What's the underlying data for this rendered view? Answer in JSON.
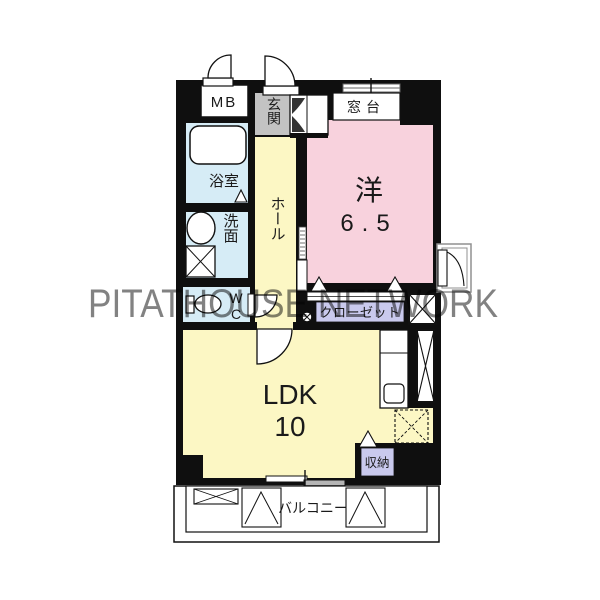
{
  "watermark": {
    "text": "PITATHOUSE NETWORK"
  },
  "colors": {
    "wall": "#0f0f0f",
    "western": "#f8d2dd",
    "ldk": "#fcf7c4",
    "hall": "#fcf7c4",
    "wet": "#d6ecf6",
    "closet": "#c9c9ed",
    "storage": "#c9c9ed",
    "genkan": "#c3c3c3",
    "watermark": "#cccccc"
  },
  "rooms": {
    "mb": {
      "label": "MB"
    },
    "genkan": {
      "label": "玄関"
    },
    "madodai": {
      "label": "窓台"
    },
    "western": {
      "label": "洋",
      "size": "6.5"
    },
    "bath": {
      "label": "浴室"
    },
    "wash": {
      "label": "洗面"
    },
    "hall": {
      "label": "ホール"
    },
    "wc": {
      "label": "WC"
    },
    "closet": {
      "label": "クローゼット"
    },
    "ldk": {
      "label": "LDK",
      "size": "10"
    },
    "storage": {
      "label": "収納"
    },
    "balcony": {
      "label": "バルコニー"
    }
  }
}
